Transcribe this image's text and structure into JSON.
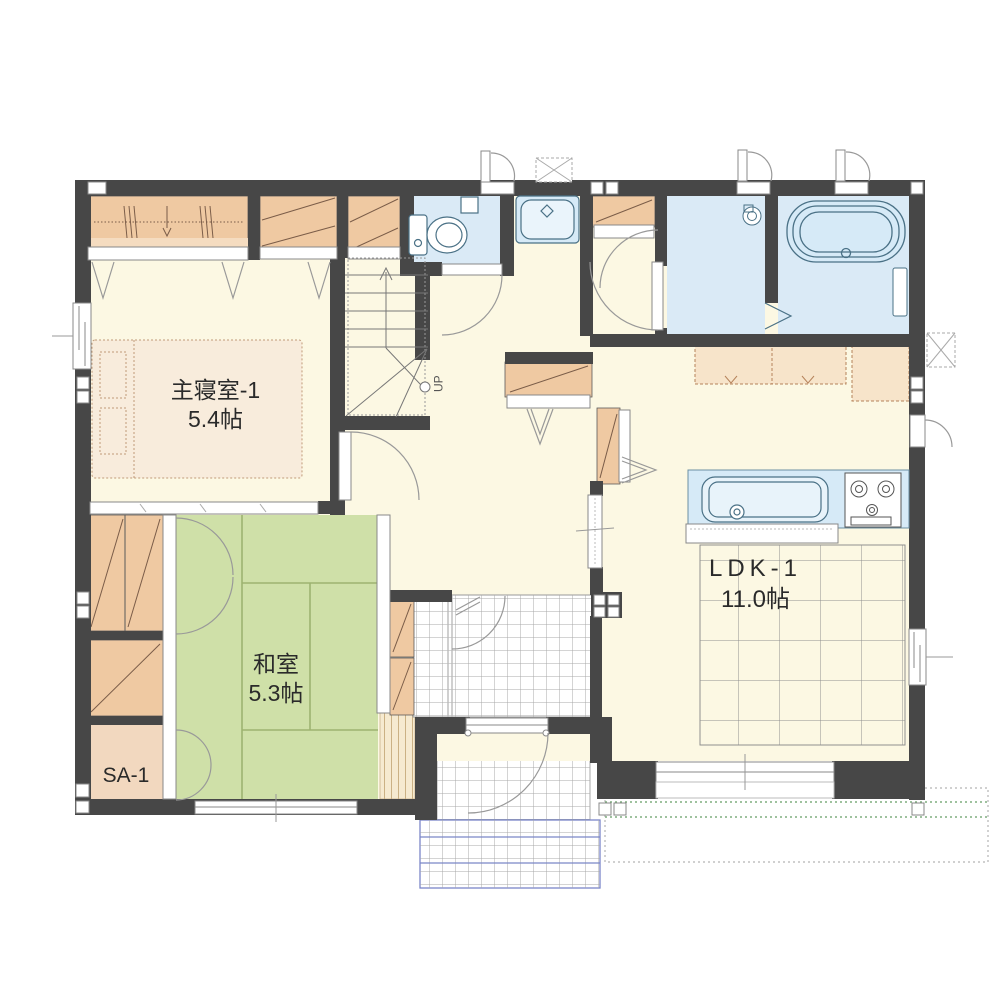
{
  "rooms": [
    {
      "id": "master-bedroom",
      "label": "主寝室-1",
      "area": "5.4帖"
    },
    {
      "id": "japanese-room",
      "label": "和室",
      "area": "5.3帖"
    },
    {
      "id": "ldk",
      "label": "LDK-1",
      "area": "11.0帖"
    },
    {
      "id": "storage-sa",
      "label": "SA-1",
      "area": ""
    }
  ],
  "stairs": {
    "label": "UP"
  },
  "icons": {
    "fixtures": [
      "bed",
      "wardrobe-closet",
      "shelf-closet",
      "stairs-up",
      "toilet",
      "washbasin",
      "bathtub",
      "washroom-drain",
      "kitchen-sink",
      "gas-stove",
      "kitchen-counter",
      "wall-cabinet",
      "shoe-cabinet",
      "tatami-mats",
      "sliding-partition",
      "hinged-door",
      "folding-door",
      "sliding-window",
      "entrance-door",
      "entrance-tile",
      "porch-tile",
      "wood-deck-outline",
      "vent-box"
    ]
  },
  "colors": {
    "wall": "#474747",
    "floor": "#fcf8e3",
    "wet_floor": "#daeaf6",
    "fixture_blue": "#d6eaf7",
    "tatami": "#cfe0a8",
    "closet": "#efc9a2",
    "closet_light": "#f5dcc0",
    "storage_floor": "#f2d8bf",
    "bed": "#f8ecdc",
    "tile_line": "#a8a8a8",
    "porch_accent": "#7b86c8",
    "deck_dots": "#7fae7f",
    "line": "#4a7186"
  }
}
